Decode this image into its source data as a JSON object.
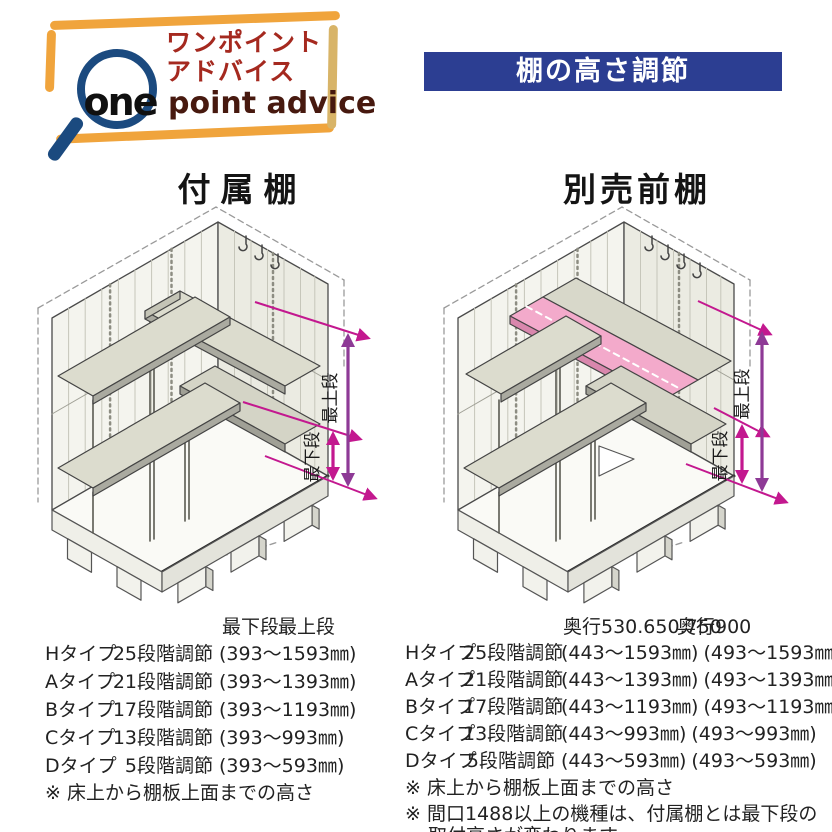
{
  "logo": {
    "one": "one",
    "jp_line1": "ワンポイント",
    "jp_line2": "アドバイス",
    "en": "point advice"
  },
  "banner": {
    "title": "棚の高さ調節"
  },
  "sections": {
    "left_heading": "付属棚",
    "right_heading": "別売前棚"
  },
  "diagram_labels": {
    "top_level": "最上段",
    "bottom_level": "最下段"
  },
  "left_table": {
    "headers": [
      "最下段",
      "最上段"
    ],
    "rows": [
      {
        "type": "Hタイプ",
        "steps": "25段階調節",
        "range": "(393〜1593㎜)"
      },
      {
        "type": "Aタイプ",
        "steps": "21段階調節",
        "range": "(393〜1393㎜)"
      },
      {
        "type": "Bタイプ",
        "steps": "17段階調節",
        "range": "(393〜1193㎜)"
      },
      {
        "type": "Cタイプ",
        "steps": "13段階調節",
        "range": "(393〜993㎜)"
      },
      {
        "type": "Dタイプ",
        "steps": "5段階調節",
        "range": "(393〜593㎜)"
      }
    ],
    "note": "※ 床上から棚板上面までの高さ"
  },
  "right_table": {
    "headers": [
      "奥行530.650.750",
      "奥行900"
    ],
    "rows": [
      {
        "type": "Hタイプ",
        "steps": "25段階調節",
        "range1": "(443〜1593㎜)",
        "range2": "(493〜1593㎜)"
      },
      {
        "type": "Aタイプ",
        "steps": "21段階調節",
        "range1": "(443〜1393㎜)",
        "range2": "(493〜1393㎜)"
      },
      {
        "type": "Bタイプ",
        "steps": "17段階調節",
        "range1": "(443〜1193㎜)",
        "range2": "(493〜1193㎜)"
      },
      {
        "type": "Cタイプ",
        "steps": "13段階調節",
        "range1": "(443〜993㎜)",
        "range2": "(493〜993㎜)"
      },
      {
        "type": "Dタイプ",
        "steps": "5段階調節",
        "range1": "(443〜593㎜)",
        "range2": "(493〜593㎜)"
      }
    ],
    "notes": [
      "※ 床上から棚板上面までの高さ",
      "※ 間口1488以上の機種は、付属棚とは最下段の取付高さが変わります。"
    ]
  },
  "colors": {
    "banner_blue": "#2c3e92",
    "logo_red": "#a5291f",
    "logo_dark_brown": "#47190f",
    "frame_orange": "#f0a43c",
    "frame_tan": "#d8b468",
    "magnifier_navy": "#1b4a7f",
    "dimension_magenta": "#c3188f",
    "dimension_purple": "#8e3a96",
    "optional_shelf_pink": "#f3aacb"
  }
}
